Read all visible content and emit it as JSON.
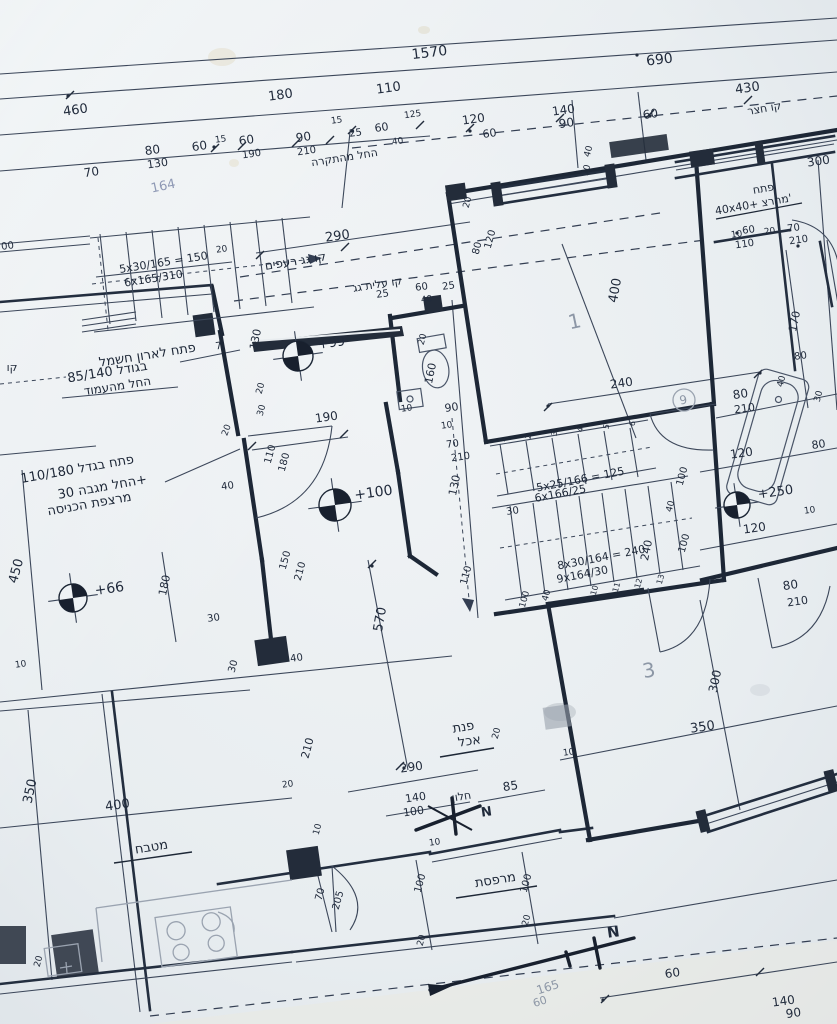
{
  "dims": [
    "1570",
    "690",
    "460",
    "180",
    "110",
    "430",
    "70",
    "80",
    "130",
    "60",
    "15",
    "60",
    "190",
    "90",
    "210",
    "15",
    "25",
    "60",
    "40",
    "125",
    "120",
    "60",
    "140",
    "90",
    "60",
    "00",
    "290",
    "20",
    "130",
    "7",
    "20",
    "20",
    "30",
    "25",
    "60",
    "40",
    "25",
    "20",
    "160",
    "10",
    "90",
    "10",
    "70",
    "210",
    "190",
    "110",
    "180",
    "40",
    "400",
    "240",
    "20",
    "80",
    "120",
    "40",
    "10",
    "300",
    "10",
    "60",
    "110",
    "20",
    "70",
    "210",
    "170",
    "80",
    "40",
    "30",
    "80",
    "210",
    "120",
    "80",
    "10",
    "120",
    "240",
    "100",
    "40",
    "100",
    "80",
    "210",
    "130",
    "30",
    "110",
    "570",
    "150",
    "210",
    "450",
    "180",
    "30",
    "40",
    "30",
    "10",
    "350",
    "400",
    "210",
    "20",
    "290",
    "140",
    "100",
    "85",
    "20",
    "10",
    "10",
    "70",
    "205",
    "100",
    "100",
    "20",
    "20",
    "300",
    "350",
    "20",
    "60",
    "140",
    "90",
    "10",
    "100",
    "40"
  ],
  "he": {
    "yard_line": "קו חצר",
    "from_ceiling": "החל מהתקרה",
    "roof_tiles_line": "קו גג רעפים",
    "attic_line": "קו עלית גג",
    "elec1": "פתח לארון חשמל",
    "elec2": "בגודל 85/140",
    "elec3": "החל מהעמוד",
    "open1": "פתח בגדל 110/180",
    "open2": "החל מגבה 30+",
    "open3": "מרצפת הכניסה",
    "dining1": "פנת",
    "dining2": "אכל",
    "window": "חלון",
    "balcony": "מרפסת",
    "kitchen": "מטבח",
    "hatch1": "פתח",
    "hatch2": "40x40+ מהרצ'",
    "kav": "קו"
  },
  "stairs": {
    "s1a": "5x30/165 = 150",
    "s1c": "6x165/310",
    "s2a": "5x25/166 = 125",
    "s2b": "6x166/25",
    "s3a": "8x30/164 = 240",
    "s3b": "9x164/30",
    "steps_upper": [
      "1",
      "2",
      "3",
      "4",
      "5",
      "6"
    ],
    "steps_lower": [
      "10",
      "11",
      "12",
      "13"
    ]
  },
  "levels": {
    "l99": "+99",
    "l100": "+100",
    "l66": "+66",
    "l250": "+250"
  },
  "rooms": {
    "r1": "1",
    "r9": "9",
    "r3": "3"
  },
  "pencil": {
    "p164": "164",
    "p165": "165",
    "p60": "60"
  },
  "north": "N",
  "colors": {
    "paper": "#e9edf0",
    "ink": "#1d2736",
    "pencil": "#8d97a6"
  }
}
